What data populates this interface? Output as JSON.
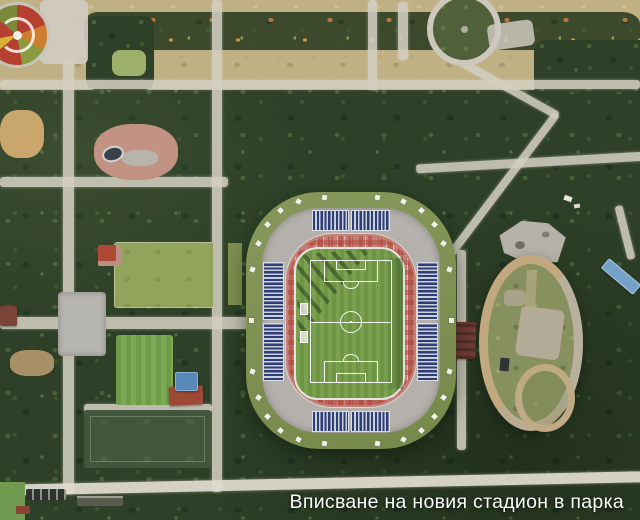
{
  "scene": {
    "type": "aerial-satellite-photomontage",
    "caption": "Вписване на новия стадион в парка"
  },
  "colors": {
    "forest": "#2e4027",
    "meadow": "#c0b184",
    "path": "#d3cec0",
    "stadium_outer_ring": "#7e9150",
    "stadium_concourse": "#b5b1ac",
    "stadium_roof_panel": "#32427c",
    "stadium_seating": "#c08179",
    "pitch_green": "#74a048",
    "pitch_lines": "#ffffff",
    "velodrome_track": "#c2a87e",
    "velodrome_infield": "#87905f",
    "playground_palette": [
      "#b5402f",
      "#cf7d2f",
      "#8a9a3f",
      "#d9b23a"
    ],
    "blue_roof": "#74a3c7",
    "red_roof": "#a04a36",
    "caption_text": "#ffffff"
  },
  "features": {
    "stadium": "rendered new football stadium",
    "velodrome": "old oval cycling track",
    "training_fields_count": 3,
    "playground": "colorful circular playground",
    "round_garden": "circular garden with ring path"
  }
}
